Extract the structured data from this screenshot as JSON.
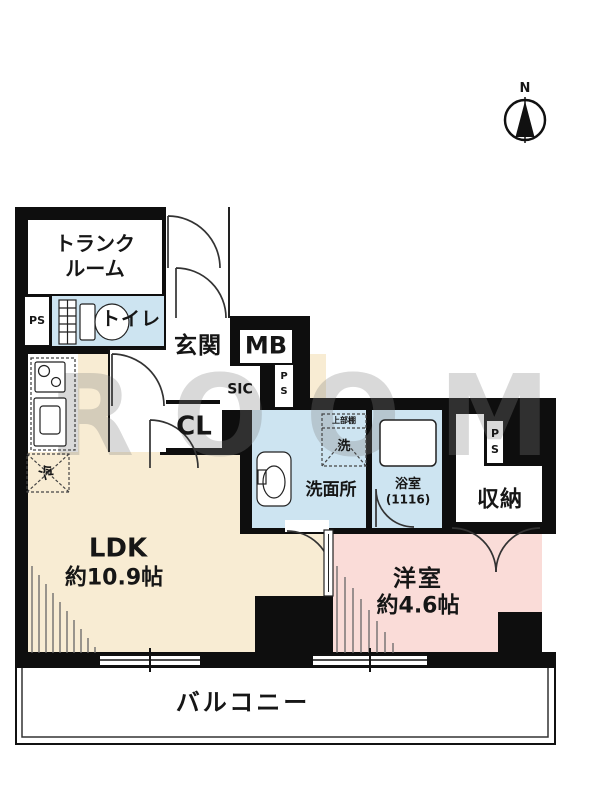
{
  "compass": {
    "north_label": "N"
  },
  "watermark": "ROOM",
  "rooms": {
    "trunk_line1": "トランク",
    "trunk_line2": "ルーム",
    "ps_left": "PS",
    "toilet": "トイレ",
    "entrance": "玄関",
    "meter_box": "MB",
    "shoe_closet": "SIC",
    "ps_mid_p": "P",
    "ps_mid_s": "S",
    "closet": "CL",
    "washroom": "洗面所",
    "laundry_shelf": "上部棚",
    "laundry": "洗",
    "bath_name": "浴室",
    "bath_size": "(1116)",
    "ps_right_p": "P",
    "ps_right_s": "S",
    "storage": "収納",
    "ldk_name": "LDK",
    "ldk_size": "約10.9帖",
    "western_name": "洋室",
    "western_size": "約4.6帖",
    "balcony": "バルコニー",
    "fridge": "冷"
  },
  "colors": {
    "ldk_floor": "#f8ecd3",
    "western_floor": "#fadcd8",
    "wet_area": "#cde4f1",
    "wall": "#0e0e0e"
  }
}
